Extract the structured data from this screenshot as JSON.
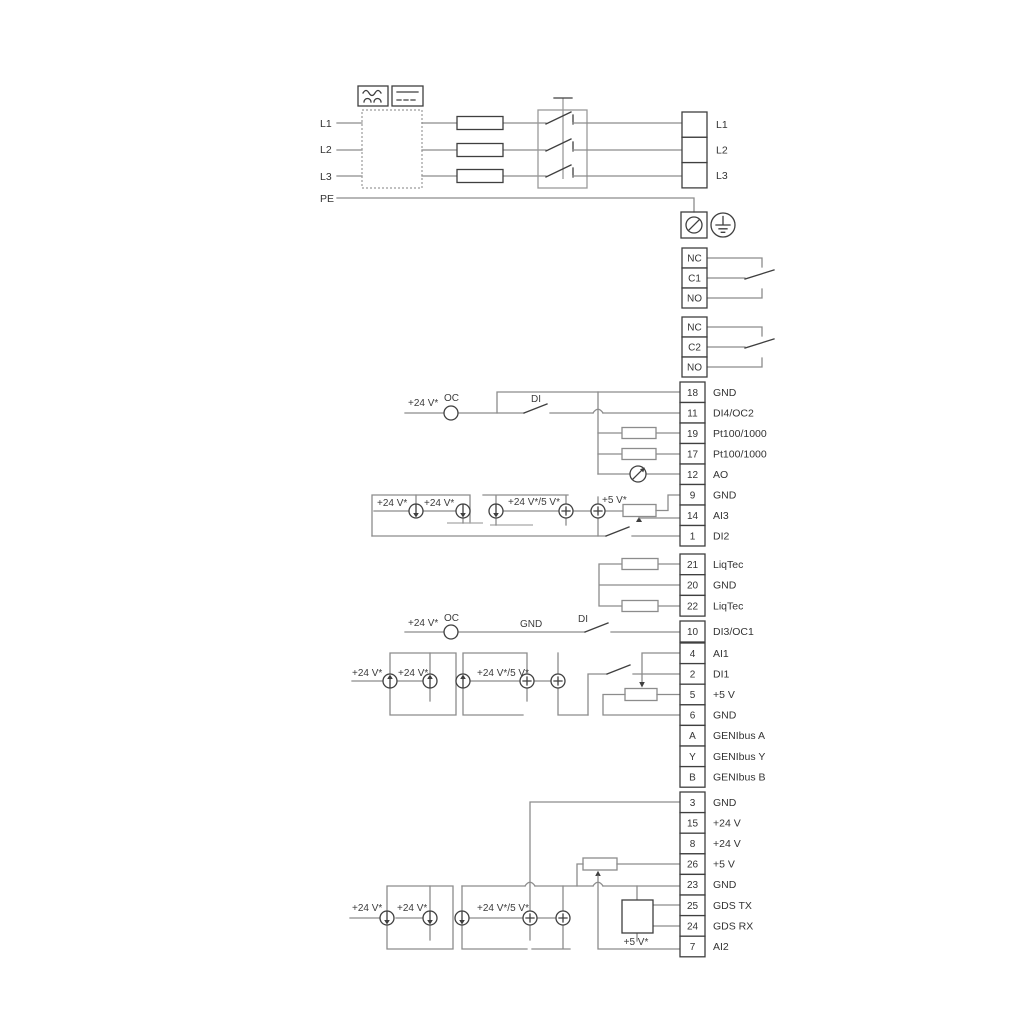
{
  "labels": {
    "l1": "L1",
    "l2": "L2",
    "l3": "L3",
    "pe": "PE"
  },
  "ann": {
    "v24": "+24 V*",
    "v24_5": "+24 V*/5 V*",
    "v5": "+5 V*",
    "oc": "OC",
    "di": "DI",
    "gnd": "GND"
  },
  "blocks": {
    "power": [
      {
        "label": "L1"
      },
      {
        "label": "L2"
      },
      {
        "label": "L3"
      }
    ],
    "relay1": [
      {
        "label": "NC"
      },
      {
        "label": "C1"
      },
      {
        "label": "NO"
      }
    ],
    "relay2": [
      {
        "label": "NC"
      },
      {
        "label": "C2"
      },
      {
        "label": "NO"
      }
    ],
    "main1": [
      {
        "num": "18",
        "label": "GND"
      },
      {
        "num": "11",
        "label": "DI4/OC2"
      },
      {
        "num": "19",
        "label": "Pt100/1000"
      },
      {
        "num": "17",
        "label": "Pt100/1000"
      },
      {
        "num": "12",
        "label": "AO"
      },
      {
        "num": "9",
        "label": "GND"
      },
      {
        "num": "14",
        "label": "AI3"
      },
      {
        "num": "1",
        "label": "DI2"
      }
    ],
    "liqtec": [
      {
        "num": "21",
        "label": "LiqTec"
      },
      {
        "num": "20",
        "label": "GND"
      },
      {
        "num": "22",
        "label": "LiqTec"
      }
    ],
    "di3": [
      {
        "num": "10",
        "label": "DI3/OC1"
      }
    ],
    "mid2": [
      {
        "num": "4",
        "label": "AI1"
      },
      {
        "num": "2",
        "label": "DI1"
      },
      {
        "num": "5",
        "label": "+5 V"
      },
      {
        "num": "6",
        "label": "GND"
      },
      {
        "num": "A",
        "label": "GENIbus A"
      },
      {
        "num": "Y",
        "label": "GENIbus Y"
      },
      {
        "num": "B",
        "label": "GENIbus B"
      }
    ],
    "bottom": [
      {
        "num": "3",
        "label": "GND"
      },
      {
        "num": "15",
        "label": "+24 V"
      },
      {
        "num": "8",
        "label": "+24 V"
      },
      {
        "num": "26",
        "label": "+5 V"
      },
      {
        "num": "23",
        "label": "GND"
      },
      {
        "num": "25",
        "label": "GDS TX"
      },
      {
        "num": "24",
        "label": "GDS RX"
      },
      {
        "num": "7",
        "label": "AI2"
      }
    ]
  },
  "colors": {
    "wire": "#8c8c8c",
    "dark": "#3f3f3f",
    "rail": "#a6a6a6"
  }
}
